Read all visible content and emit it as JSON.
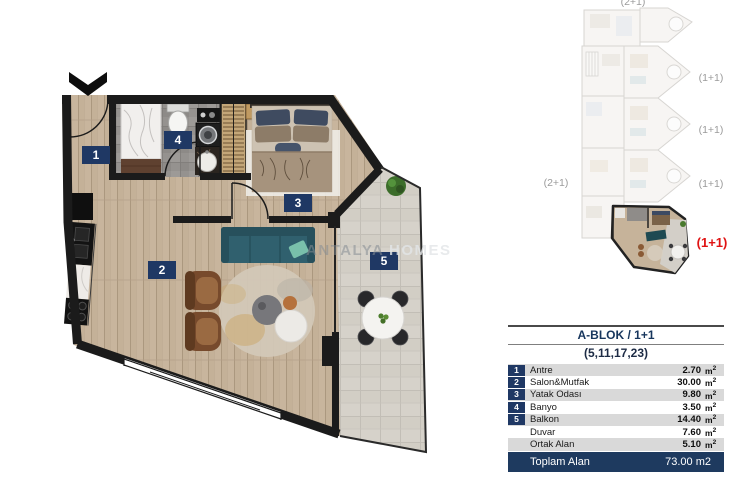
{
  "floorplan": {
    "watermark": {
      "left": "ANTALYA",
      "right": "HOMES"
    },
    "rooms": [
      {
        "num": "1"
      },
      {
        "num": "2"
      },
      {
        "num": "3"
      },
      {
        "num": "4"
      },
      {
        "num": "5"
      }
    ],
    "colors": {
      "wall": "#1b1b1b",
      "label_bg": "#1f3864",
      "wood": "#c8b59d",
      "balcony_floor": "#d6d2ca",
      "bath_floor": "#95928f"
    }
  },
  "keyplan": {
    "label_top": "(2+1)",
    "label_left": "(2+1)",
    "unit_labels": [
      "(1+1)",
      "(1+1)",
      "(1+1)"
    ],
    "highlight_label": "(1+1)",
    "highlight_color": "#e01313"
  },
  "table": {
    "title": "A-BLOK / 1+1",
    "subtitle": "(5,11,17,23)",
    "rows": [
      {
        "num": "1",
        "name": "Antre",
        "value": "2.70",
        "unit_base": "m",
        "unit_sup": "2"
      },
      {
        "num": "2",
        "name": "Salon&Mutfak",
        "value": "30.00",
        "unit_base": "m",
        "unit_sup": "2"
      },
      {
        "num": "3",
        "name": "Yatak Odası",
        "value": "9.80",
        "unit_base": "m",
        "unit_sup": "2"
      },
      {
        "num": "4",
        "name": "Banyo",
        "value": "3.50",
        "unit_base": "m",
        "unit_sup": "2"
      },
      {
        "num": "5",
        "name": "Balkon",
        "value": "14.40",
        "unit_base": "m",
        "unit_sup": "2"
      },
      {
        "num": "",
        "name": "Duvar",
        "value": "7.60",
        "unit_base": "m",
        "unit_sup": "2"
      },
      {
        "num": "",
        "name": "Ortak Alan",
        "value": "5.10",
        "unit_base": "m",
        "unit_sup": "2"
      }
    ],
    "footer": {
      "label": "Toplam Alan",
      "value": "73.00 m2"
    },
    "colors": {
      "navy": "#1f3864",
      "stripe": "#d9d9d9",
      "footer_bg": "#1e3a5f"
    }
  }
}
